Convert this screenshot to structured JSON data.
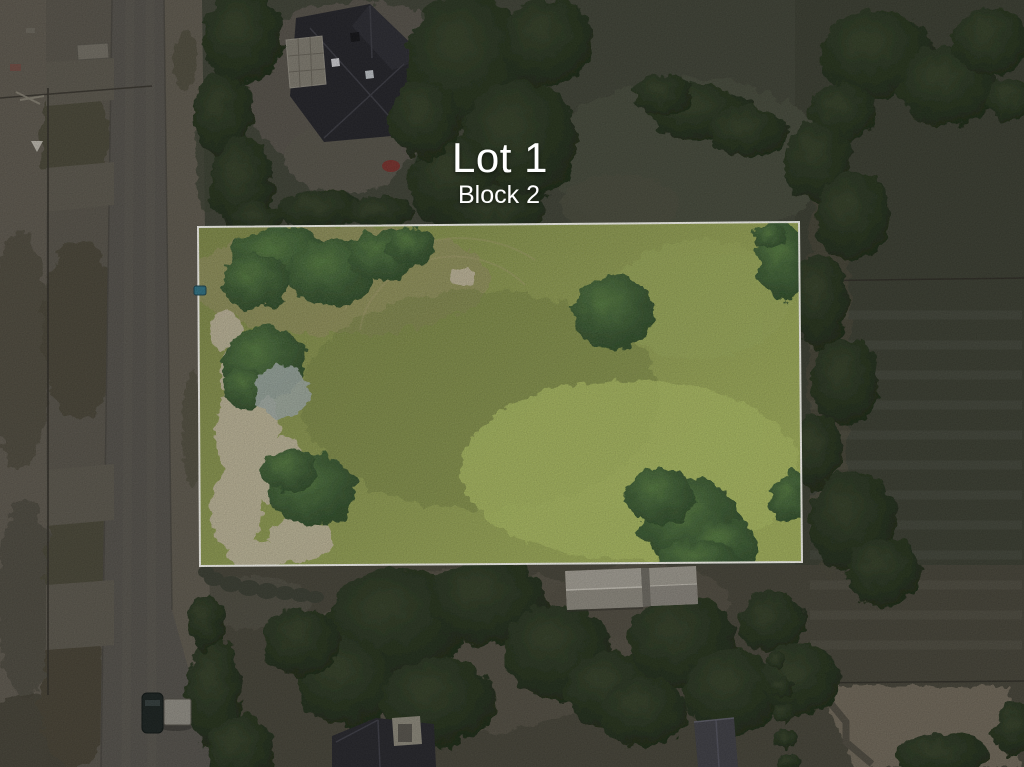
{
  "overlay": {
    "lot_label": "Lot 1",
    "block_label": "Block 2"
  },
  "colors": {
    "text": "#ffffff",
    "boundary": "#f2f1ea",
    "surround-dim": "#3f4236",
    "road": "#54514b",
    "dirt": "#57534a",
    "parcel-green": "#89964b",
    "parcel-green-bright": "#a6b75c",
    "parcel-sand": "#bcb299",
    "tree-dark": "#25301d",
    "tree-bright": "#34532b",
    "barn-roof": "#a09c92",
    "house-roof": "#232328",
    "trailer": "#8f8c83",
    "marker-teal": "#2f6f80"
  }
}
